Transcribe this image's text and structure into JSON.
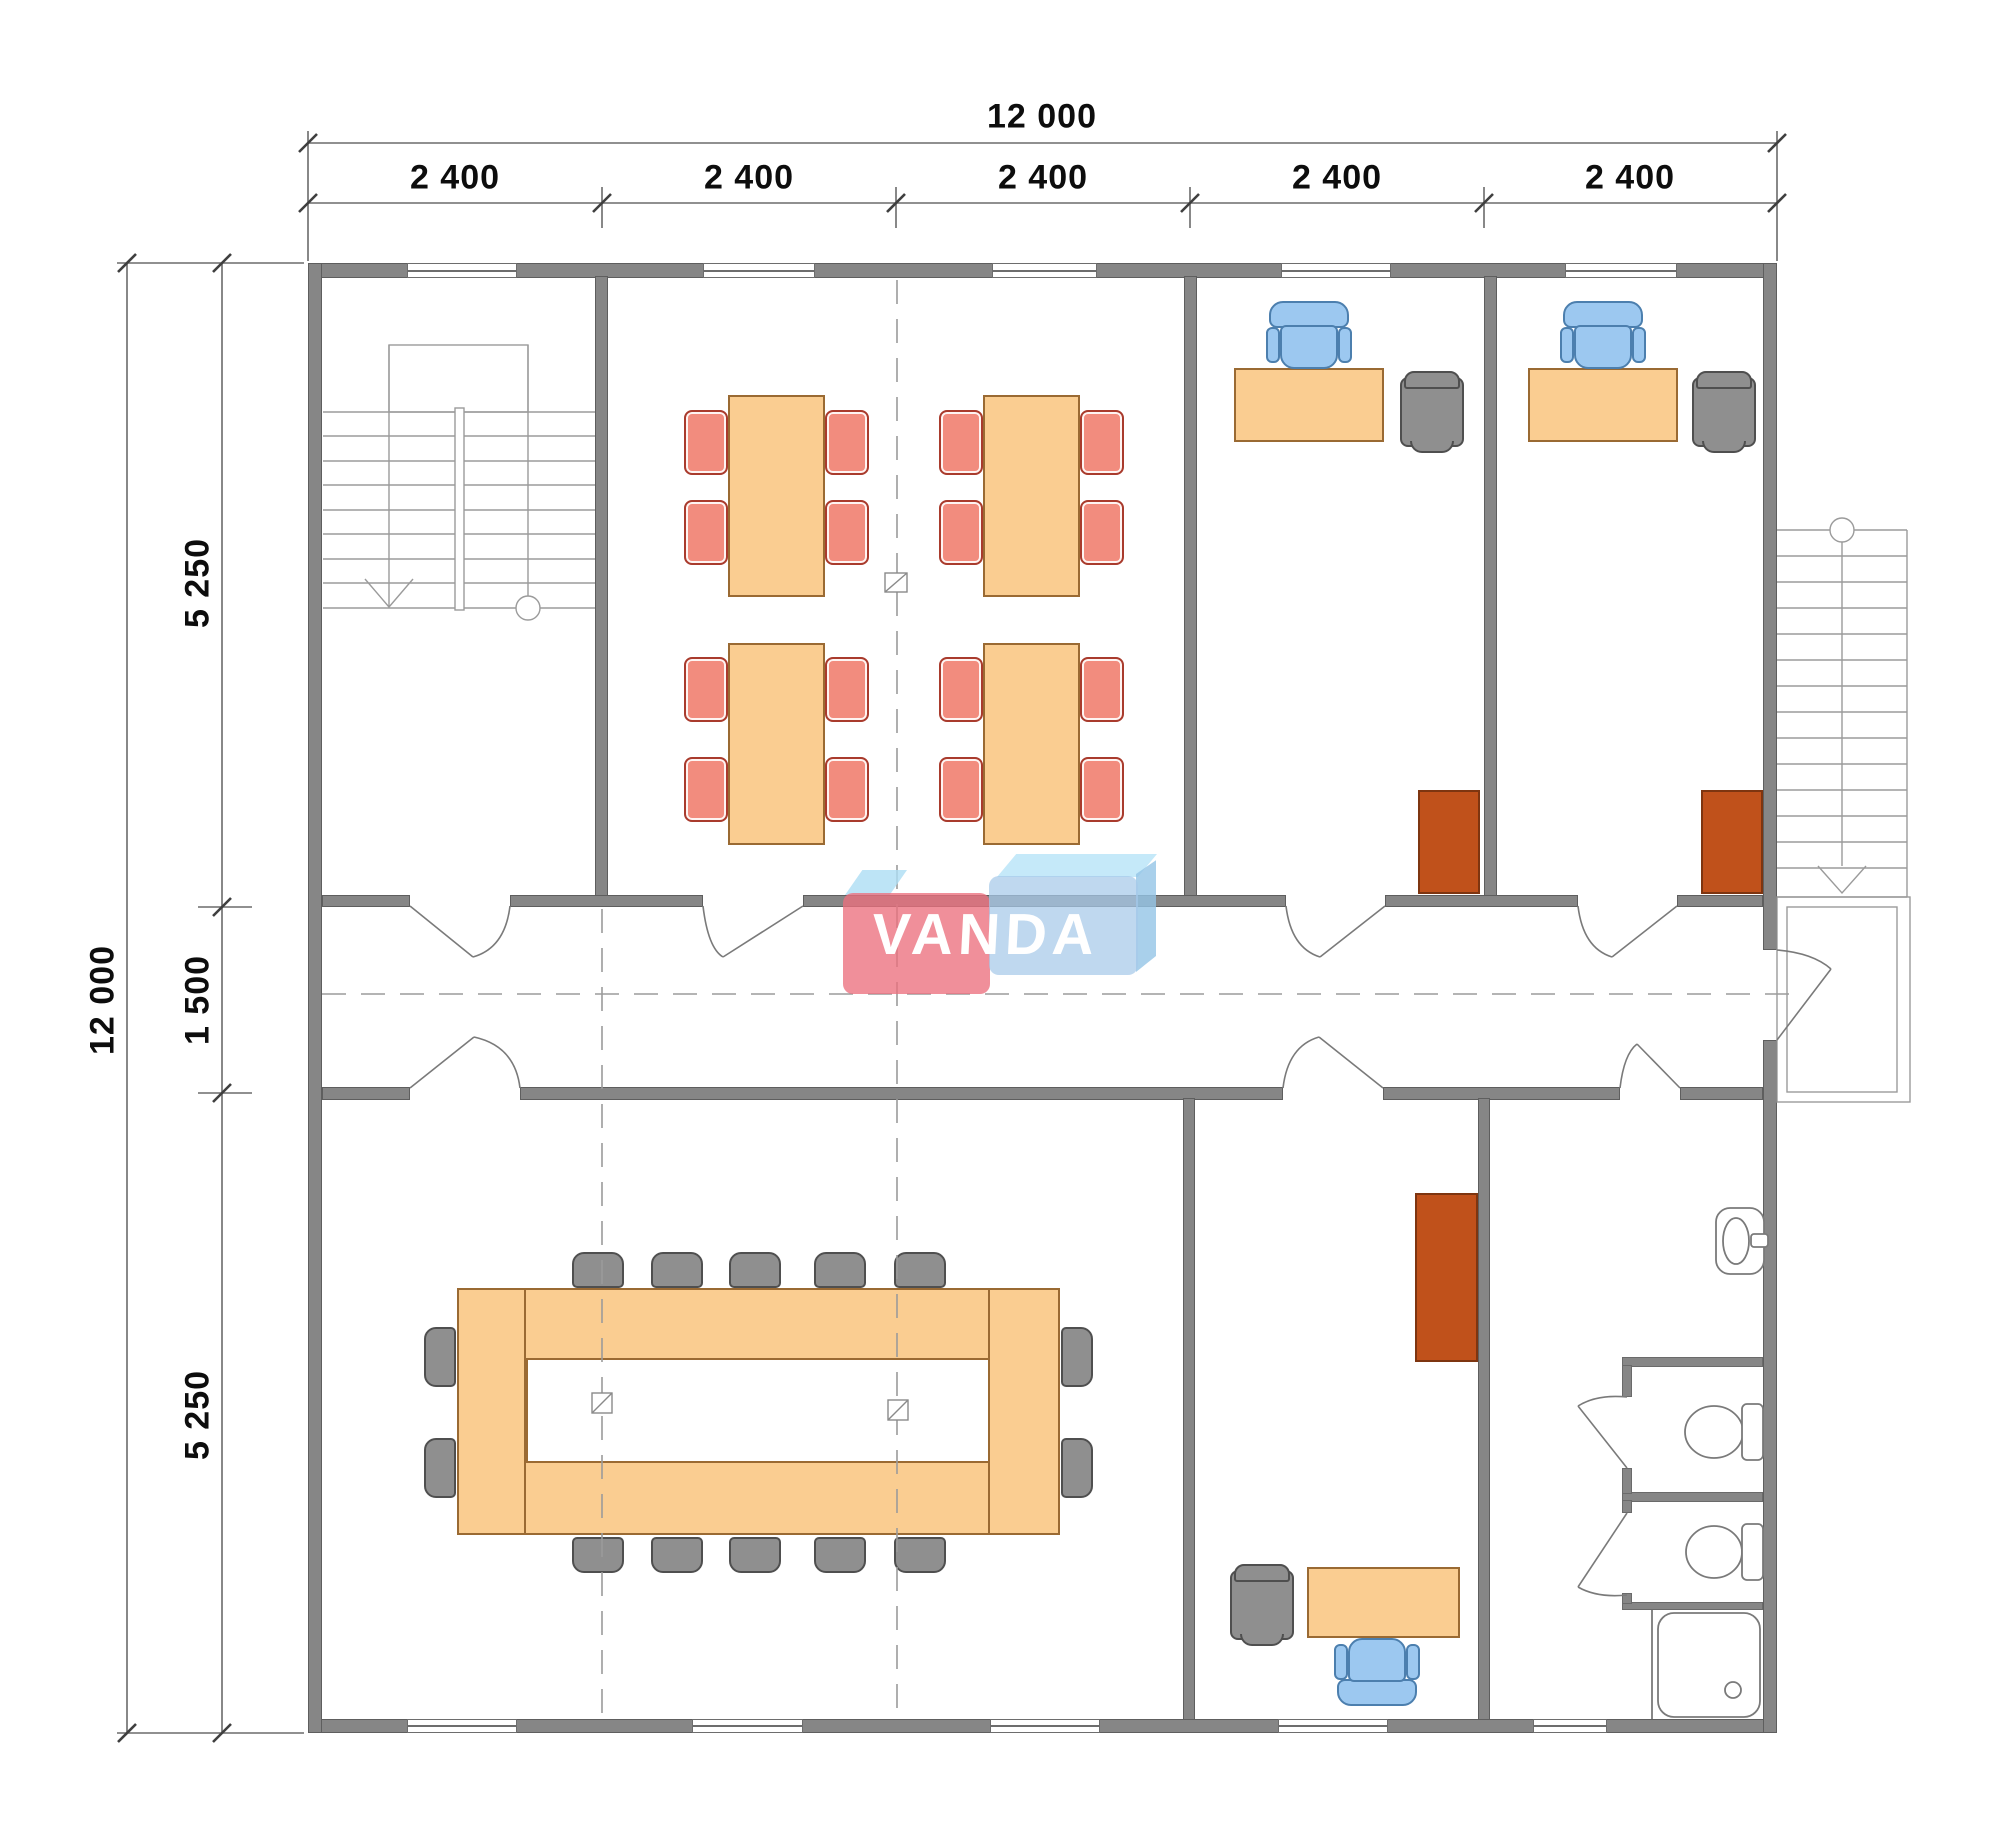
{
  "drawing": {
    "type": "architectural floor plan",
    "logo_text": "VANDA"
  },
  "dimensions": {
    "top_total": "12 000",
    "top_bays": [
      "2 400",
      "2 400",
      "2 400",
      "2 400",
      "2 400"
    ],
    "left_total": "12 000",
    "left_segments": [
      "5 250",
      "1 500",
      "5 250"
    ]
  },
  "colors": {
    "wall": "#868686",
    "table": "#FACD91",
    "table_border": "#9A6A33",
    "chair_red": "#F28C7E",
    "chair_red_border": "#A93B2D",
    "chair_blue": "#9CC8F0",
    "chair_blue_border": "#4C7FAE",
    "chair_gray": "#8F8F8F",
    "cabinet_brown": "#C0511B",
    "logo_pink": "#EC707E",
    "logo_blue": "#A6C9E9",
    "dimension_text": "#0d0d0d"
  }
}
